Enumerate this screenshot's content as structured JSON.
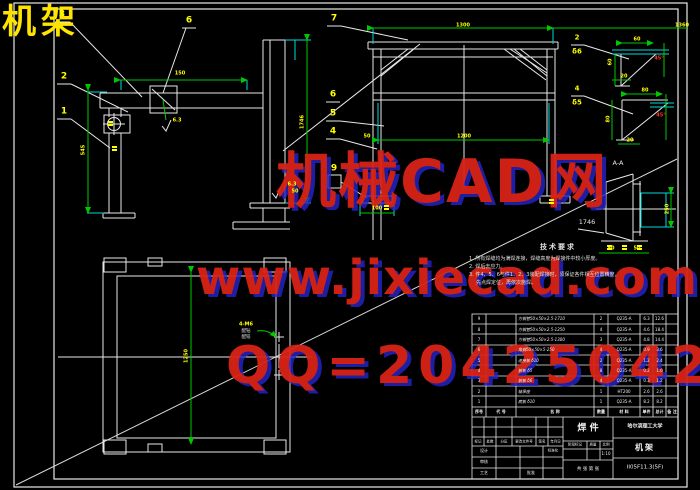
{
  "sheet": {
    "corner_title": "机架"
  },
  "watermark": {
    "line1": "机械CAD网",
    "line2": "www.jixiecad.com",
    "line3": "QQ=20425042",
    "color": "#d92318",
    "shadow_color": "#2626cc"
  },
  "views": {
    "section_label": "A-A",
    "dim_1746": "1746",
    "holes_label": "4-M6",
    "drill_note_line1": "配钻",
    "drill_note_line2": "配铰"
  },
  "balloons": {
    "b1": "1",
    "b2": "2",
    "b3": "3",
    "b4": "4",
    "b5": "5",
    "b6a": "6",
    "b6b": "6",
    "b7": "7",
    "b9": "9",
    "f_num": "2",
    "f_thk": "δ6",
    "g_num": "4",
    "g_thk": "δ5"
  },
  "dims": {
    "va_top": "150",
    "va_left": "545",
    "va_weld": "6.3",
    "va_weld2": "6.3",
    "vb_height": "1746",
    "vb_low": "50",
    "vc_top": "1300",
    "vc_top2": "1360",
    "vc_mid": "1200",
    "vc_mid_left": "50",
    "vc_bl": "100",
    "vd_center": "1250",
    "aa_right": "250",
    "aa_b1": "50",
    "aa_b2": "50",
    "f_top": "60",
    "f_left": "60",
    "f_bot": "20",
    "f_angle": "45°",
    "g_top": "80",
    "g_left": "80",
    "g_bot": "20",
    "g_angle": "45°"
  },
  "tech_notes": {
    "title": "技术要求",
    "lines": [
      "1. 所有焊缝均为满焊连接，焊缝高度为焊接件中较小厚度。",
      "2. 焊后去应力。",
      "3. 件4、5、6与件1、2、3装配焊接时，须保证各件相互位置精度，",
      "先点焊定位，再依次施焊。"
    ]
  },
  "bom": {
    "headers": [
      "序号",
      "代  号",
      "名  称",
      "数量",
      "材  料",
      "单件",
      "总计",
      "备 注"
    ],
    "rows": [
      [
        "9",
        "",
        "方钢管50×50×2.5-1710",
        "2",
        "Q235-A",
        "6.3",
        "12.6",
        ""
      ],
      [
        "8",
        "",
        "方钢管50×50×2.5-1250",
        "4",
        "Q235-A",
        "4.6",
        "18.4",
        ""
      ],
      [
        "7",
        "",
        "方钢管50×50×2.5-1300",
        "3",
        "Q235-A",
        "4.8",
        "14.4",
        ""
      ],
      [
        "6",
        "",
        "角钢50×50×5-250",
        "4",
        "Q235-A",
        "0.9",
        "3.6",
        ""
      ],
      [
        "5",
        "",
        "连接板 δ10",
        "2",
        "Q235-A",
        "1.2",
        "2.4",
        ""
      ],
      [
        "4",
        "",
        "筋板 δ5",
        "8",
        "Q235-A",
        "0.2",
        "1.6",
        ""
      ],
      [
        "3",
        "",
        "筋板 δ6",
        "4",
        "Q235-A",
        "0.3",
        "1.2",
        ""
      ],
      [
        "2",
        "",
        "轴承座",
        "1",
        "HT200",
        "2.6",
        "2.6",
        ""
      ],
      [
        "1",
        "",
        "底板 δ10",
        "1",
        "Q235-A",
        "8.2",
        "8.2",
        ""
      ]
    ]
  },
  "title_block": {
    "school": "哈尔滨理工大学",
    "product_cell": "焊  件",
    "drawing_title": "机架",
    "drawing_number": "II05F11.3(5F)",
    "stage_label": "阶段标记",
    "mass_label": "质量",
    "scale_label": "比例",
    "scale_value": "1:10",
    "sheet_note": "共 张 第 张",
    "change_row": [
      "标记",
      "处数",
      "分区",
      "更改文件号",
      "签名",
      "年月日"
    ],
    "design_label": "设计",
    "standard_label": "标准化",
    "audit_label": "审核",
    "process_label": "工艺",
    "approve_label": "批准"
  }
}
